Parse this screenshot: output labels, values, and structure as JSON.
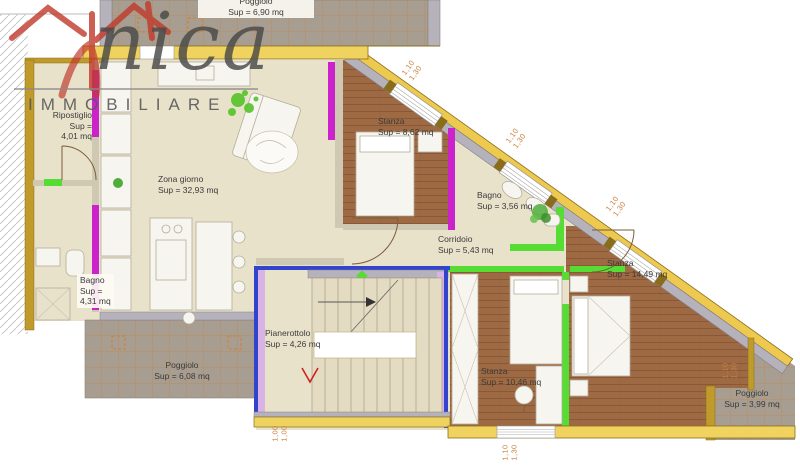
{
  "logo": {
    "brand_script": "nica",
    "subtitle": "IMMOBILIARE",
    "accent_red": "#c0392b",
    "accent_green": "#55c32a"
  },
  "rooms": [
    {
      "name": "Poggiolo",
      "area": "Sup = 6,90 mq"
    },
    {
      "name": "Ripostiglio",
      "sup": "Sup =",
      "value": "4,01 mq"
    },
    {
      "name": "Zona giorno",
      "area": "Sup = 32,93 mq"
    },
    {
      "name": "Stanza",
      "area": "Sup = 8,62 mq"
    },
    {
      "name": "Bagno",
      "area": "Sup = 3,56 mq"
    },
    {
      "name": "Corridoio",
      "area": "Sup = 5,43 mq"
    },
    {
      "name": "Stanza",
      "area": "Sup = 14,49 mq"
    },
    {
      "name": "Bagno",
      "sup": "Sup =",
      "value": "4,31 mq"
    },
    {
      "name": "Pianerottolo",
      "area": "Sup = 4,26 mq"
    },
    {
      "name": "Stanza",
      "area": "Sup = 10,46 mq"
    },
    {
      "name": "Poggiolo",
      "area": "Sup = 6,08 mq"
    },
    {
      "name": "Poggiolo",
      "area": "Sup = 3,99 mq"
    }
  ],
  "dimensions": [
    {
      "line1": "1,10",
      "line2": "1,30"
    },
    {
      "line1": "1,10",
      "line2": "1,30"
    },
    {
      "line1": "1,10",
      "line2": "1,30"
    },
    {
      "line1": "1,00",
      "line2": "1,00"
    },
    {
      "line1": "1,10",
      "line2": "1,30"
    },
    {
      "line1": "1,10",
      "line2": "1,30"
    }
  ],
  "colors": {
    "wall_yellow": "#f0d35e",
    "wall_gold": "#c09a2a",
    "wall_gray": "#b5b2bb",
    "wall_magenta": "#cc22cc",
    "wall_green": "#55dd33",
    "wall_blue": "#3344cc",
    "wall_lavender": "#d9b3e6",
    "floor_beige": "#e9e2cb",
    "floor_wood": "#9e6a44",
    "terrace_gray": "#a79e91",
    "dim_text": "#c87f3c"
  }
}
